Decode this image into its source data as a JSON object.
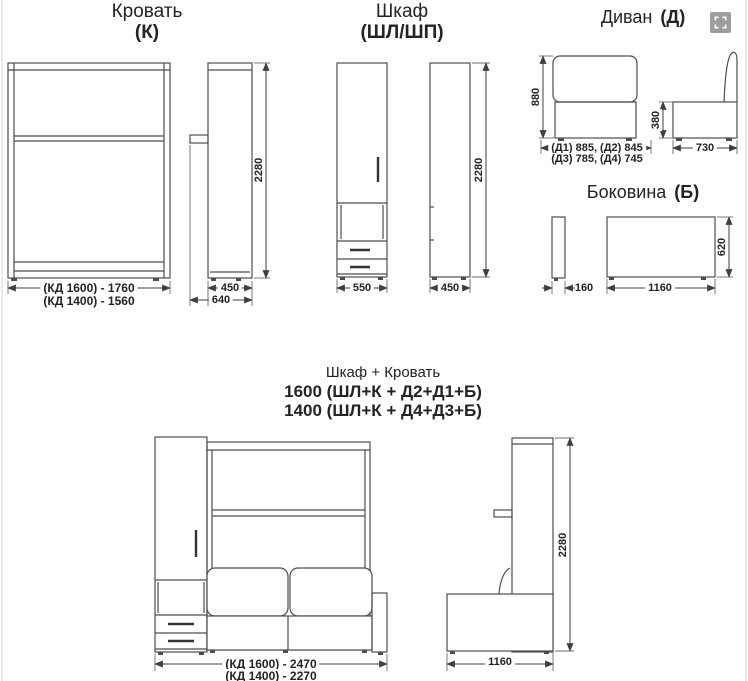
{
  "viewer": {
    "fullscreen_icon": "expand-icon"
  },
  "bed": {
    "title": "Кровать",
    "code": "(К)",
    "dims": {
      "height": "2280",
      "width_1600": "(КД 1600) - 1760",
      "width_1400": "(КД 1400) - 1560",
      "depth_inner": "450",
      "depth_outer": "640"
    }
  },
  "wardrobe": {
    "title": "Шкаф",
    "code": "(ШЛ/ШП)",
    "dims": {
      "height": "2280",
      "width": "550",
      "depth": "450"
    }
  },
  "sofa": {
    "title": "Диван",
    "code": "(Д)",
    "dims": {
      "height": "880",
      "widths_d1_d2": "(Д1) 885, (Д2) 845",
      "widths_d3_d4": "(Д3) 785, (Д4) 745",
      "seat_height": "380",
      "depth": "730"
    }
  },
  "side_panel": {
    "title": "Боковина",
    "code": "(Б)",
    "dims": {
      "thickness": "160",
      "length": "1160",
      "height": "620"
    }
  },
  "combo": {
    "title": "Шкаф + Кровать",
    "variant_1600": "1600 (ШЛ+К + Д2+Д1+Б)",
    "variant_1400": "1400 (ШЛ+К + Д4+Д3+Б)",
    "dims": {
      "width_1600": "(КД 1600) - 2470",
      "width_1400": "(КД 1400) - 2270",
      "height": "2280",
      "depth": "1160"
    }
  }
}
